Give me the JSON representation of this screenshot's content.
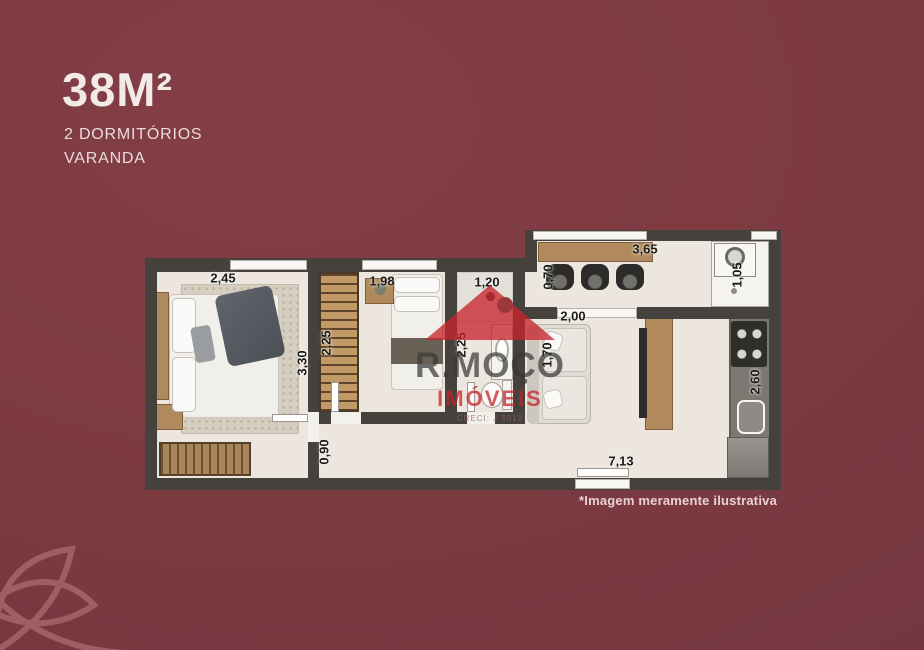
{
  "colors": {
    "background": "#7c3a41",
    "wall": "#45413c",
    "floor": "#ece6de",
    "wood": "#b08a5d",
    "accent_red": "#c8242b",
    "title_text": "#f1eae7"
  },
  "header": {
    "area_title": "38M²",
    "subtitle_line1": "2 DORMITÓRIOS",
    "subtitle_line2": "VARANDA"
  },
  "watermark": {
    "brand": "R.MOÇO",
    "segment": "IMÓVEIS",
    "license": "CRECI: J 5012"
  },
  "footnote": "*Imagem meramente ilustrativa",
  "floorplan": {
    "dimensions": [
      {
        "label": "2,45",
        "orientation": "h"
      },
      {
        "label": "3,30",
        "orientation": "v"
      },
      {
        "label": "2,25",
        "orientation": "v"
      },
      {
        "label": "1,98",
        "orientation": "h"
      },
      {
        "label": "1,20",
        "orientation": "h"
      },
      {
        "label": "2,25",
        "orientation": "v"
      },
      {
        "label": "0,70",
        "orientation": "v"
      },
      {
        "label": "3,65",
        "orientation": "h"
      },
      {
        "label": "1,05",
        "orientation": "v"
      },
      {
        "label": "2,00",
        "orientation": "h"
      },
      {
        "label": "1,70",
        "orientation": "v"
      },
      {
        "label": "2,60",
        "orientation": "v"
      },
      {
        "label": "0,90",
        "orientation": "v"
      },
      {
        "label": "7,13",
        "orientation": "h"
      }
    ]
  }
}
